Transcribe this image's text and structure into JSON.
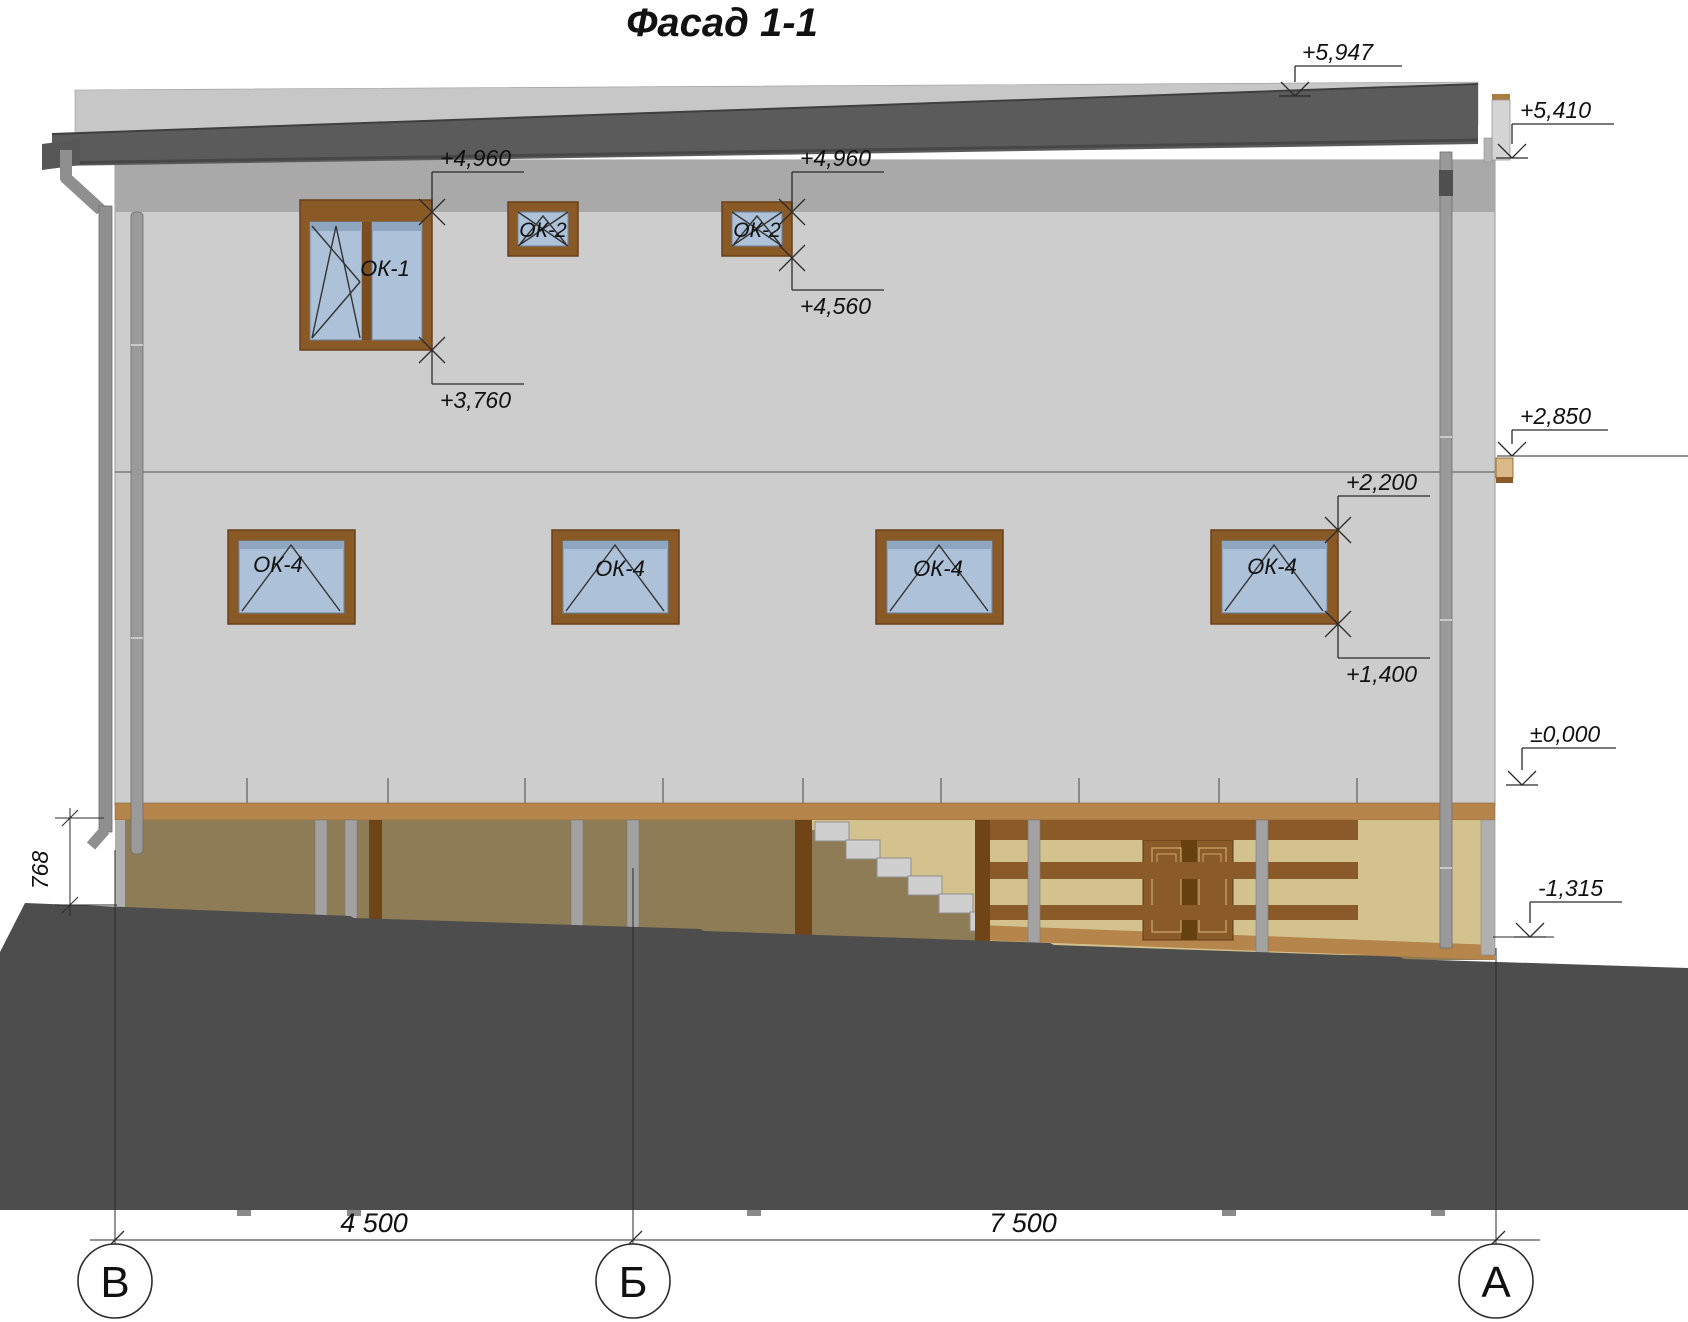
{
  "title": "Фасад 1-1",
  "window_labels": {
    "ok1": "ОК-1",
    "ok2": "ОК-2",
    "ok4": "ОК-4"
  },
  "elevation_marks": {
    "upper_roof": "+5,947",
    "roof_edge": "+5,410",
    "upper_window_top": "+4,960",
    "ok2_sill": "+4,560",
    "ok1_sill": "+3,760",
    "canopy_beam": "+2,850",
    "ok4_head": "+2,200",
    "ok4_sill": "+1,400",
    "ground_floor": "±0,000",
    "basement": "-1,315"
  },
  "dimensions": {
    "plinth": "768",
    "v_to_b": "4 500",
    "b_to_a": "7 500"
  },
  "axes": {
    "v": "В",
    "b": "Б",
    "a": "А"
  },
  "colors": {
    "roof": "#5b5b5b",
    "roof_back_band": "#c7c7c7",
    "eaves_band": "#a9a9a9",
    "wall": "#cdcdcd",
    "ground": "#4d4d4d",
    "slab_band": "#b5854b",
    "timber_dark": "#8a5a28",
    "panel_tan": "#d3c28e",
    "panel_olive": "#8d7c55",
    "window_frame": "#8a5a26",
    "glass": "#adc1d8"
  }
}
